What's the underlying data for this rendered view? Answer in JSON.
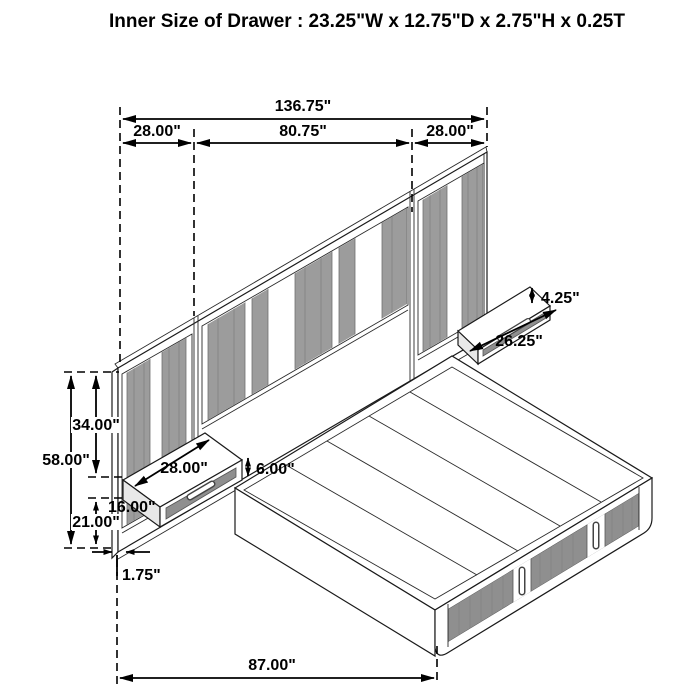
{
  "title": "Inner Size of Drawer : 23.25\"W x 12.75\"D x 2.75\"H x 0.25T",
  "dimensions": {
    "overall_width": "136.75\"",
    "left_panel_width": "28.00\"",
    "center_panel_width": "80.75\"",
    "right_panel_width": "28.00\"",
    "right_shelf_height": "4.25\"",
    "right_shelf_width": "26.25\"",
    "left_shelf_width": "28.00\"",
    "left_shelf_height": "6.00\"",
    "headboard_height": "58.00\"",
    "panel_top_to_shelf": "34.00\"",
    "floor_to_shelf_bottom": "16.00\"",
    "lower_section_height": "21.00\"",
    "panel_thickness": "1.75\"",
    "bed_length": "87.00\""
  },
  "colors": {
    "background": "#ffffff",
    "line": "#1a1a1a",
    "panel_stripe_gray": "#9c9c9c",
    "drawer_front_gray": "#8f8f8f",
    "end_face_gray": "#e8e8e8"
  }
}
